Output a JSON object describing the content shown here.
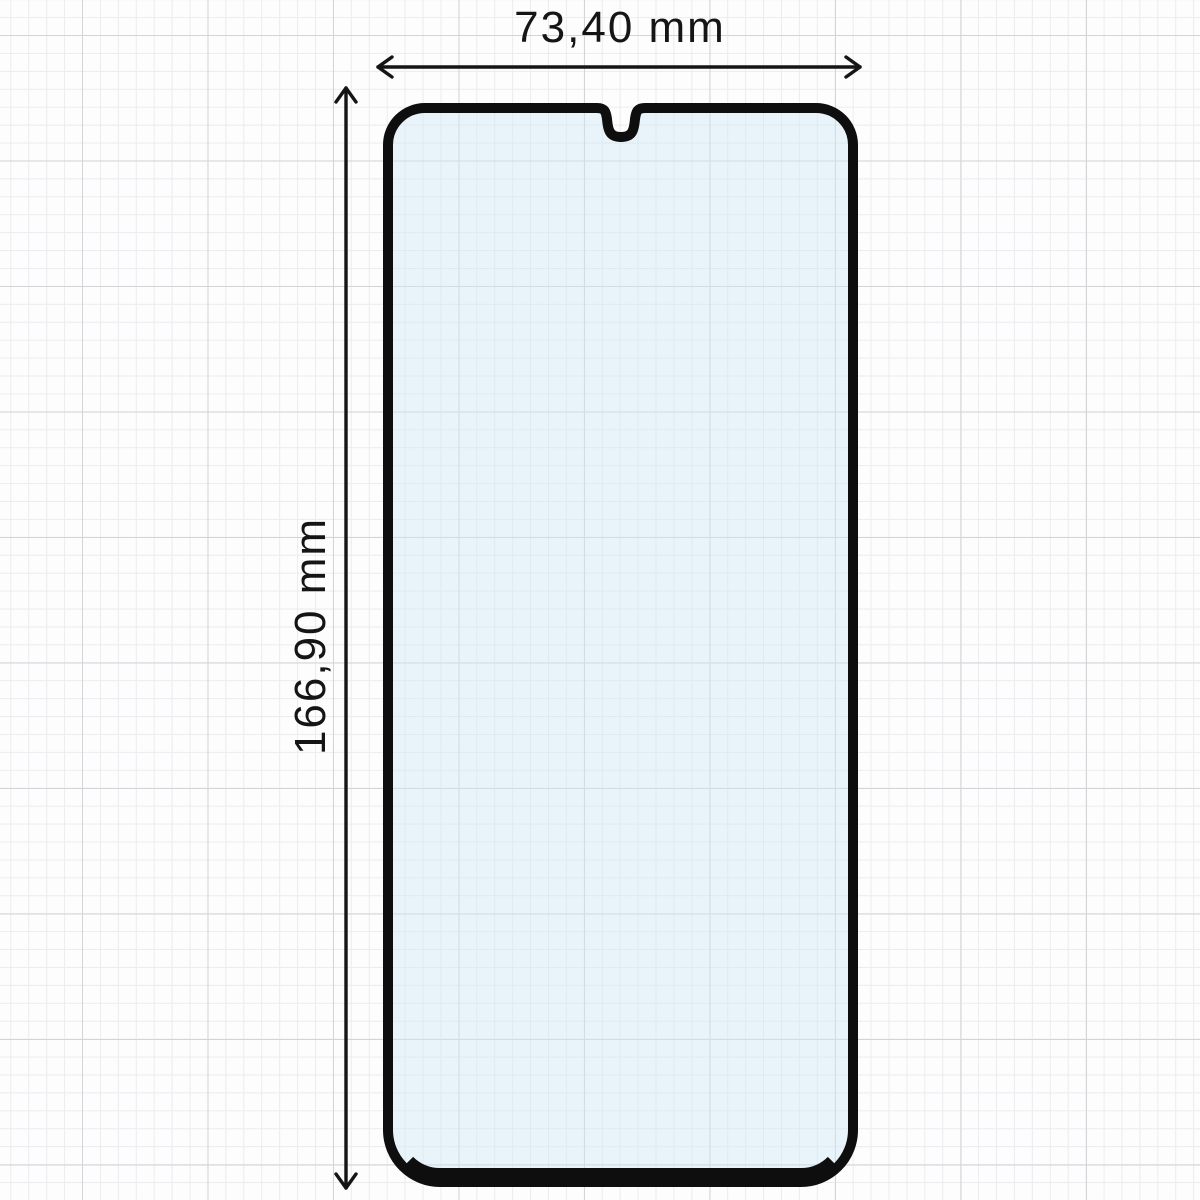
{
  "diagram": {
    "description": "Dimensioned outline drawing of a phone screen protector with waterdrop camera notch on graph paper",
    "width_label": "73,40 mm",
    "height_label": "166,90 mm",
    "width_value_mm": "73,40",
    "height_value_mm": "166,90",
    "unit": "mm"
  },
  "icons": {
    "horizontal_arrow": "double-headed-horizontal-dimension-arrow",
    "vertical_arrow": "double-headed-vertical-dimension-arrow",
    "camera_notch": "waterdrop-notch-cutout"
  },
  "colors": {
    "background": "#fdfdfe",
    "grid_minor": "#ececf0",
    "grid_major": "#d3d3d8",
    "outline": "#0e0e0f",
    "glass_fill": "#cfe8f4",
    "arrow": "#151515",
    "text": "#151515"
  }
}
